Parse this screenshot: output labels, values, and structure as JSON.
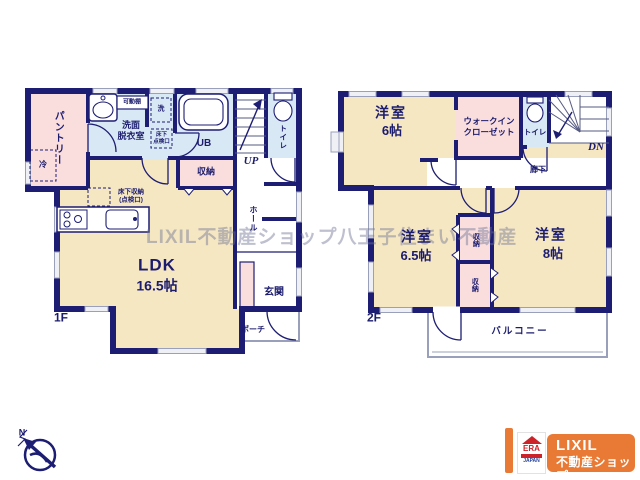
{
  "watermark": "LIXIL不動産ショップ八王子住まい不動産",
  "floor1": {
    "label": "1F",
    "rooms": {
      "pantry": "パントリー",
      "fridge": "冷",
      "washroom": "洗面\n脱衣室",
      "shelf": "可動棚",
      "washer": "洗",
      "underfloor_access": "床下\n点検口",
      "unit_bath": "UB",
      "toilet": "トイレ",
      "stairs": "UP",
      "storage": "収納",
      "underfloor_storage": "床下収納\n(点検口)",
      "ldk": "LDK",
      "ldk_size": "16.5帖",
      "hall": "ホール",
      "entrance": "玄関",
      "porch": "ポーチ"
    }
  },
  "floor2": {
    "label": "2F",
    "rooms": {
      "bedroom1": "洋室",
      "bedroom1_size": "6帖",
      "wic": "ウォークイン\nクローゼット",
      "toilet": "トイレ",
      "stairs": "DN",
      "corridor": "廊下",
      "bedroom2": "洋室",
      "bedroom2_size": "6.5帖",
      "storage_upper": "収納",
      "storage_lower": "収納",
      "bedroom3": "洋室",
      "bedroom3_size": "8帖",
      "balcony": "バルコニー"
    }
  },
  "compass": {
    "north": "N"
  },
  "logo": {
    "era_name": "ERA",
    "era_country": "JAPAN",
    "brand": "LIXIL",
    "brand_sub": "不動産ショップ"
  },
  "colors": {
    "wall": "#1d1d73",
    "room_cream": "#f6e7c3",
    "room_pink": "#fadede",
    "room_blue": "#d9e8f5",
    "window": "#eef0f5",
    "logo_orange": "#e87a35",
    "logo_red": "#cc2229",
    "logo_blue": "#27439b"
  }
}
